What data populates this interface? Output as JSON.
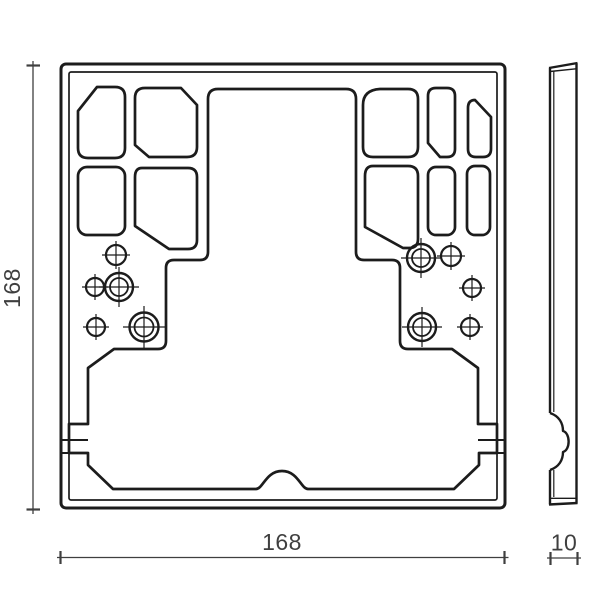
{
  "drawing": {
    "dimensions": {
      "height_label": "168",
      "width_label": "168",
      "depth_label": "10"
    },
    "colors": {
      "line": "#1c1c1c",
      "dimension": "#3f3f3f",
      "background": "#ffffff"
    }
  }
}
